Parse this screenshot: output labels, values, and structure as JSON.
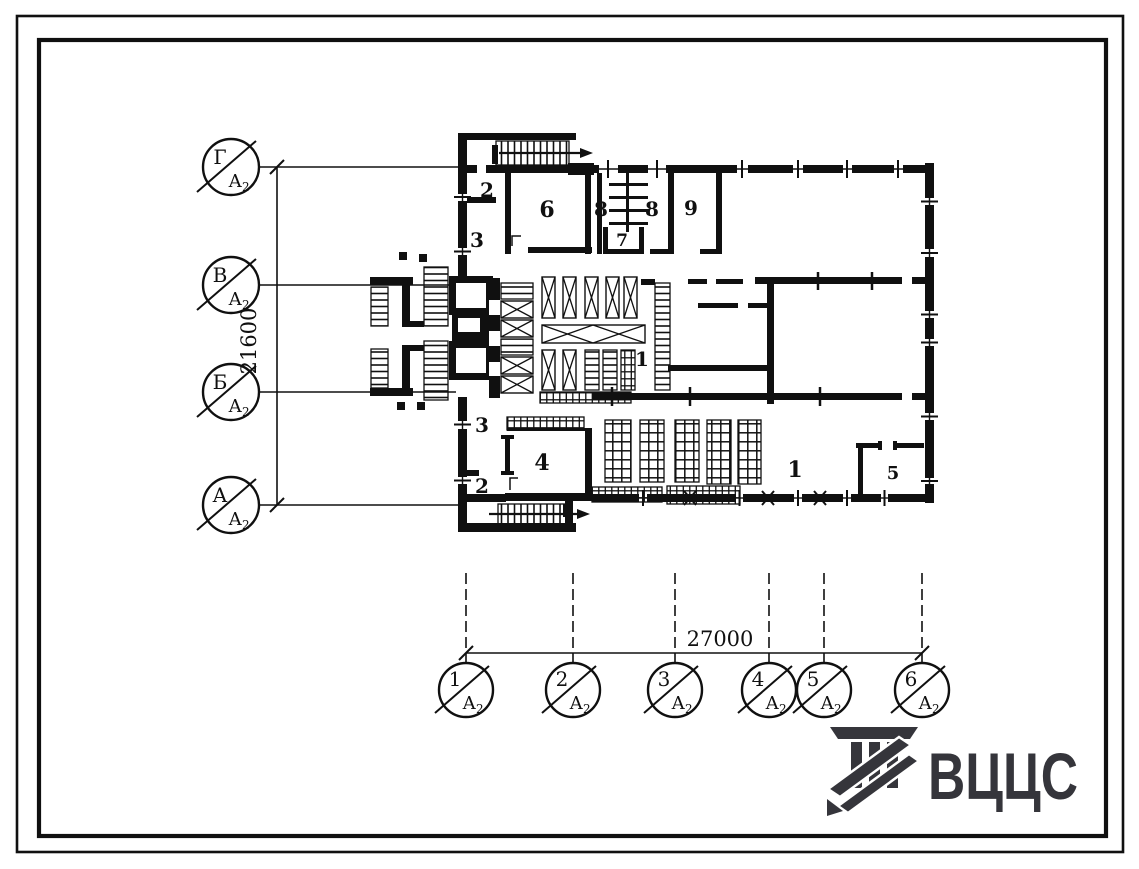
{
  "document": {
    "type": "architectural floor plan (typical design sheet)",
    "sheet_ref": "А",
    "sheet_ref_sub": "2"
  },
  "plan": {
    "room_labels": [
      {
        "text": "2",
        "x": 487,
        "y": 197,
        "size": 20
      },
      {
        "text": "3",
        "x": 477,
        "y": 247,
        "size": 20
      },
      {
        "text": "6",
        "x": 547,
        "y": 217,
        "size": 22
      },
      {
        "text": "8",
        "x": 601,
        "y": 216,
        "size": 20
      },
      {
        "text": "8",
        "x": 652,
        "y": 216,
        "size": 20
      },
      {
        "text": "7",
        "x": 622,
        "y": 246,
        "size": 17
      },
      {
        "text": "9",
        "x": 691,
        "y": 215,
        "size": 20
      },
      {
        "text": "1",
        "x": 642,
        "y": 366,
        "size": 20
      },
      {
        "text": "3",
        "x": 482,
        "y": 432,
        "size": 20
      },
      {
        "text": "4",
        "x": 542,
        "y": 470,
        "size": 22
      },
      {
        "text": "2",
        "x": 482,
        "y": 493,
        "size": 20
      },
      {
        "text": "1",
        "x": 795,
        "y": 477,
        "size": 22
      },
      {
        "text": "5",
        "x": 893,
        "y": 479,
        "size": 18
      }
    ]
  },
  "axes": {
    "left": {
      "dimension": "21600",
      "markers": [
        {
          "label": "Г",
          "cx": 231,
          "cy": 167
        },
        {
          "label": "В",
          "cx": 231,
          "cy": 285
        },
        {
          "label": "Б",
          "cx": 231,
          "cy": 392
        },
        {
          "label": "А",
          "cx": 231,
          "cy": 505
        }
      ]
    },
    "bottom": {
      "dimension": "27000",
      "markers": [
        {
          "label": "1",
          "cx": 466,
          "cy": 690
        },
        {
          "label": "2",
          "cx": 573,
          "cy": 690
        },
        {
          "label": "3",
          "cx": 675,
          "cy": 690
        },
        {
          "label": "4",
          "cx": 769,
          "cy": 690
        },
        {
          "label": "5",
          "cx": 824,
          "cy": 690
        },
        {
          "label": "6",
          "cx": 922,
          "cy": 690
        }
      ]
    },
    "sheet_ref": "А",
    "sheet_ref_sub": "2"
  },
  "logo": {
    "text": "ВЦЦС"
  },
  "colors": {
    "ink": "#101010",
    "logo": "#35353b",
    "paper": "#ffffff"
  }
}
